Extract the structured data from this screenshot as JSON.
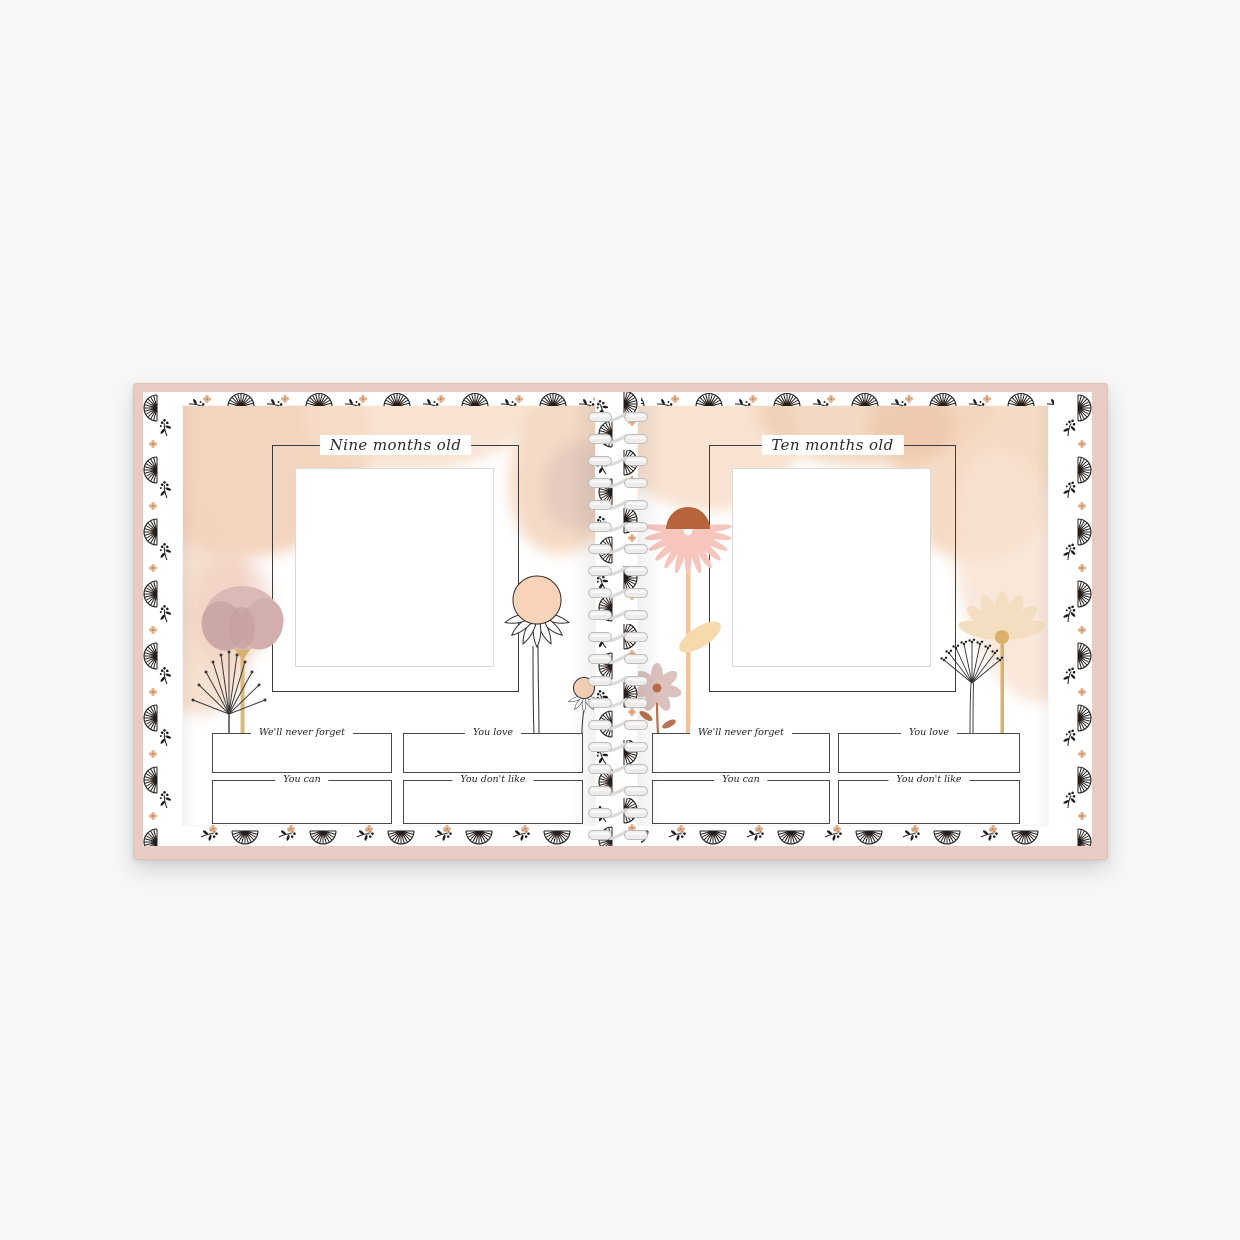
{
  "scene": {
    "background_color": "#f7f7f7",
    "subject": "Open spiral-bound baby milestone memory book product photo"
  },
  "book": {
    "cover_color": "#e8cbc3",
    "border_pattern": {
      "paper_color": "#ffffff",
      "ink_color": "#1f1f1f",
      "accent_color": "#f2c3a4",
      "motifs": [
        "fan-daisy",
        "wildflower-sprig",
        "peach-blossom"
      ]
    },
    "binding": {
      "style": "white double-loop spiral coil",
      "coil_color": "#ededed",
      "coil_count": 20
    },
    "pages": [
      {
        "side": "left",
        "title": "Nine months old",
        "fields": [
          {
            "label": "We'll never forget"
          },
          {
            "label": "You love"
          },
          {
            "label": "You can"
          },
          {
            "label": "You don't like"
          }
        ],
        "illustrations": [
          "mauve-poppy",
          "dandelion-seed-head",
          "outlined-coneflower-large",
          "outlined-coneflower-small"
        ]
      },
      {
        "side": "right",
        "title": "Ten months old",
        "fields": [
          {
            "label": "We'll never forget"
          },
          {
            "label": "You love"
          },
          {
            "label": "You can"
          },
          {
            "label": "You don't like"
          }
        ],
        "illustrations": [
          "pink-coneflower",
          "mauve-daisy-small",
          "cream-daisy",
          "queen-annes-lace"
        ]
      }
    ]
  }
}
